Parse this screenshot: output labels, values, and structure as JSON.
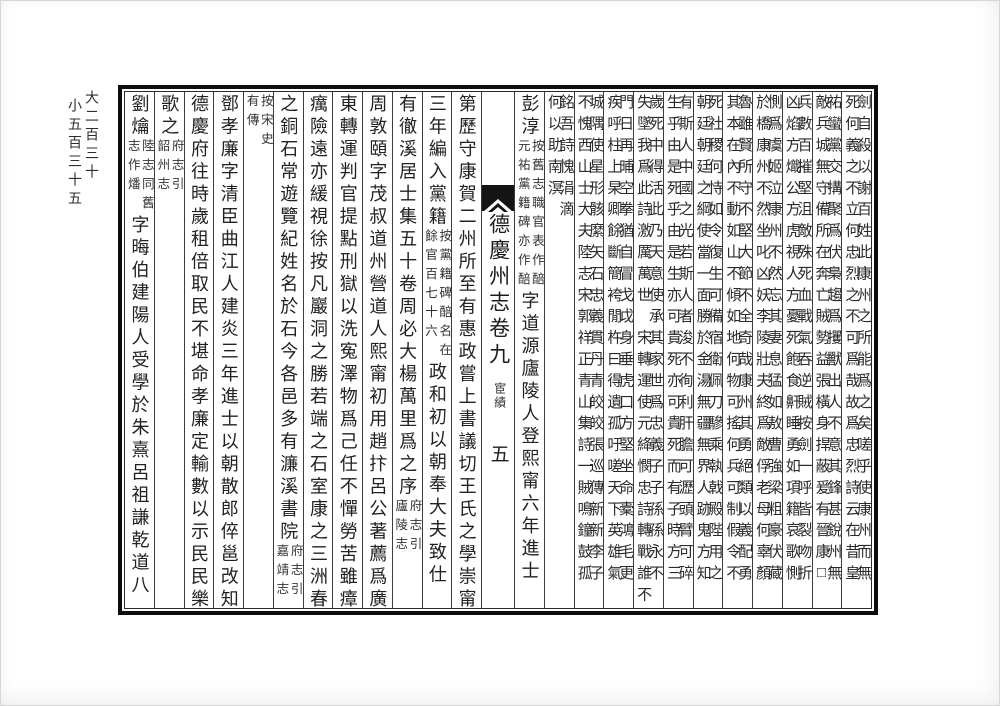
{
  "colors": {
    "ink": "#1f1f1f",
    "paper": "#ffffff",
    "frame": "#0d0d0d"
  },
  "page": {
    "margin_note": {
      "right_line": "大二百三十",
      "left_line": "小五百三十五"
    },
    "center_column": {
      "title": "德慶州志卷九",
      "section": "宦績",
      "page_number": "五"
    },
    "columns": [
      {
        "segments": [
          {
            "t": "p",
            "r": "劍自殺以謝百姓此康州之所能爲之矣嗟乎使康州而無",
            "l": "死何義之不立何忠烈之不可爲哉故爲忠烈詩云在昔皇"
          }
        ]
      },
      {
        "segments": [
          {
            "t": "p",
            "r": "祐蠻黨交搆聚爲伏梟趨爲攫獸出人不意其鋒甚銳州無",
            "l": "敵兵城無守備所在奔亡賊勢益張橫身捍蔽爰有晉康□"
          }
        ]
      },
      {
        "segments": [
          {
            "t": "p",
            "r": "兵數百摧堅沮敵殊死血戰氣吞逆賊按劍一呼皆裂吻折",
            "l": "凶焰方熾公方虎視人方憂死飽食鼾睡勇如項籍哀歌惻"
          }
        ]
      },
      {
        "segments": [
          {
            "t": "p",
            "r": "惻爲虞姬泣康州不然忘其妻息猛如敖曹強梁粗豪伏藏",
            "l": "於橋康州不然坐叱凶妖李陵壯夫終爲敵俘老母何辜顏"
          }
        ]
      },
      {
        "segments": [
          {
            "t": "p",
            "r": "魯雖賢所守不堅大節不全奇哉康州其勇絕類以義配勇",
            "l": "其本在內不動如山不傾如地何物可搖何兵可制假令不"
          }
        ]
      },
      {
        "segments": [
          {
            "t": "p",
            "r": "死社稷何恃如令復生可備宿衛佩刀驂乘執戟殿陛用之",
            "l": "朝廷朝廷之綱使當一面勝於金湯無疆無界人跡鬼方知"
          }
        ]
      },
      {
        "segments": [
          {
            "t": "p",
            "r": "有斯人中國之光若斯人者浚不徇利肝膽可瀝頭臂可碎",
            "l": "生乎由是死乎由是生亦可貴死亦可貴死而有子時方三"
          }
        ]
      },
      {
        "segments": [
          {
            "t": "p",
            "r": "歲死中得活此乃天意使承其家世爲忠義子子孫孫永不",
            "l": "失墜我爲此詩激厲萬世　宋轉運使元絳憫忠詩轉戰誰不"
          }
        ]
      },
      {
        "segments": [
          {
            "t": "p",
            "r": "門日再晡空拳猶自冒戈戉身垂虎口方堅坐命橐鴻毛更",
            "l": "疾呼柱上杲卿餘斷簡袴閒杵曰得遺孤吁嗟天下英雄氣"
          }
        ]
      },
      {
        "segments": [
          {
            "t": "p",
            "r": "城隅使星形骸縻矢石忠義貫丹青皎皎張巡傳新新李子",
            "l": "不愧西山士大夫陸志宋郭祥正青山集詩一賊鳴鐘鼓孤"
          }
        ]
      },
      {
        "segments": [
          {
            "t": "p",
            "r": "銘吾詩愧涓滴",
            "l": "何以助南溟"
          }
        ]
      },
      {
        "segments": [
          {
            "t": "l",
            "text": "彭淳"
          },
          {
            "t": "n",
            "r": "按舊志職官表作醅",
            "l": "元祐黨籍碑亦作醅"
          },
          {
            "t": "l",
            "text": "字道源廬陵人登熙甯六年進士"
          }
        ]
      },
      {
        "type": "center"
      },
      {
        "segments": [
          {
            "t": "l",
            "text": "第歷守康賀二州所至有惠政嘗上書議切王氏之學崇甯"
          }
        ]
      },
      {
        "segments": [
          {
            "t": "l",
            "text": "三年編入黨籍"
          },
          {
            "t": "n",
            "r": "按黨籍碑醅名在",
            "l": "餘官百七十六"
          },
          {
            "t": "l",
            "text": "政和初以朝奉大夫致仕"
          }
        ]
      },
      {
        "segments": [
          {
            "t": "l",
            "text": "有徹溪居士集五十卷周必大楊萬里爲之序"
          },
          {
            "t": "n",
            "r": "府志引",
            "l": "廬陵志"
          }
        ]
      },
      {
        "segments": [
          {
            "t": "l",
            "text": "周敦頤字茂叔道州營道人熙甯初用趙抃呂公著薦爲廣"
          }
        ]
      },
      {
        "segments": [
          {
            "t": "l",
            "text": "東轉運判官提點刑獄以洗寃澤物爲己任不憚勞苦雖瘴"
          }
        ]
      },
      {
        "segments": [
          {
            "t": "l",
            "text": "癘險遠亦緩視徐按凡巖洞之勝若端之石室康之三洲春"
          }
        ]
      },
      {
        "segments": [
          {
            "t": "l",
            "text": "之銅石常遊覽紀姓名於石今各邑多有濂溪書院"
          },
          {
            "t": "n",
            "r": "府志引",
            "l": "嘉靖志"
          }
        ]
      },
      {
        "segments": [
          {
            "t": "n",
            "r": "按宋史",
            "l": "有傳"
          }
        ]
      },
      {
        "segments": [
          {
            "t": "l",
            "text": "鄧孝廉字清臣曲江人建炎三年進士以朝散郎倅邕改知"
          }
        ]
      },
      {
        "segments": [
          {
            "t": "l",
            "text": "德慶府往時歲租倍取民不堪命孝廉定輸數以示民民樂"
          }
        ]
      },
      {
        "segments": [
          {
            "t": "l",
            "text": "歌之"
          },
          {
            "t": "n",
            "r": "府志引",
            "l": "韶州志"
          }
        ]
      },
      {
        "segments": [
          {
            "t": "l",
            "text": "劉爚"
          },
          {
            "t": "n",
            "r": "陸志同舊",
            "l": "志作燔"
          },
          {
            "t": "l",
            "text": "字晦伯建陽人受學於朱熹呂祖謙乾道八"
          }
        ]
      }
    ]
  }
}
